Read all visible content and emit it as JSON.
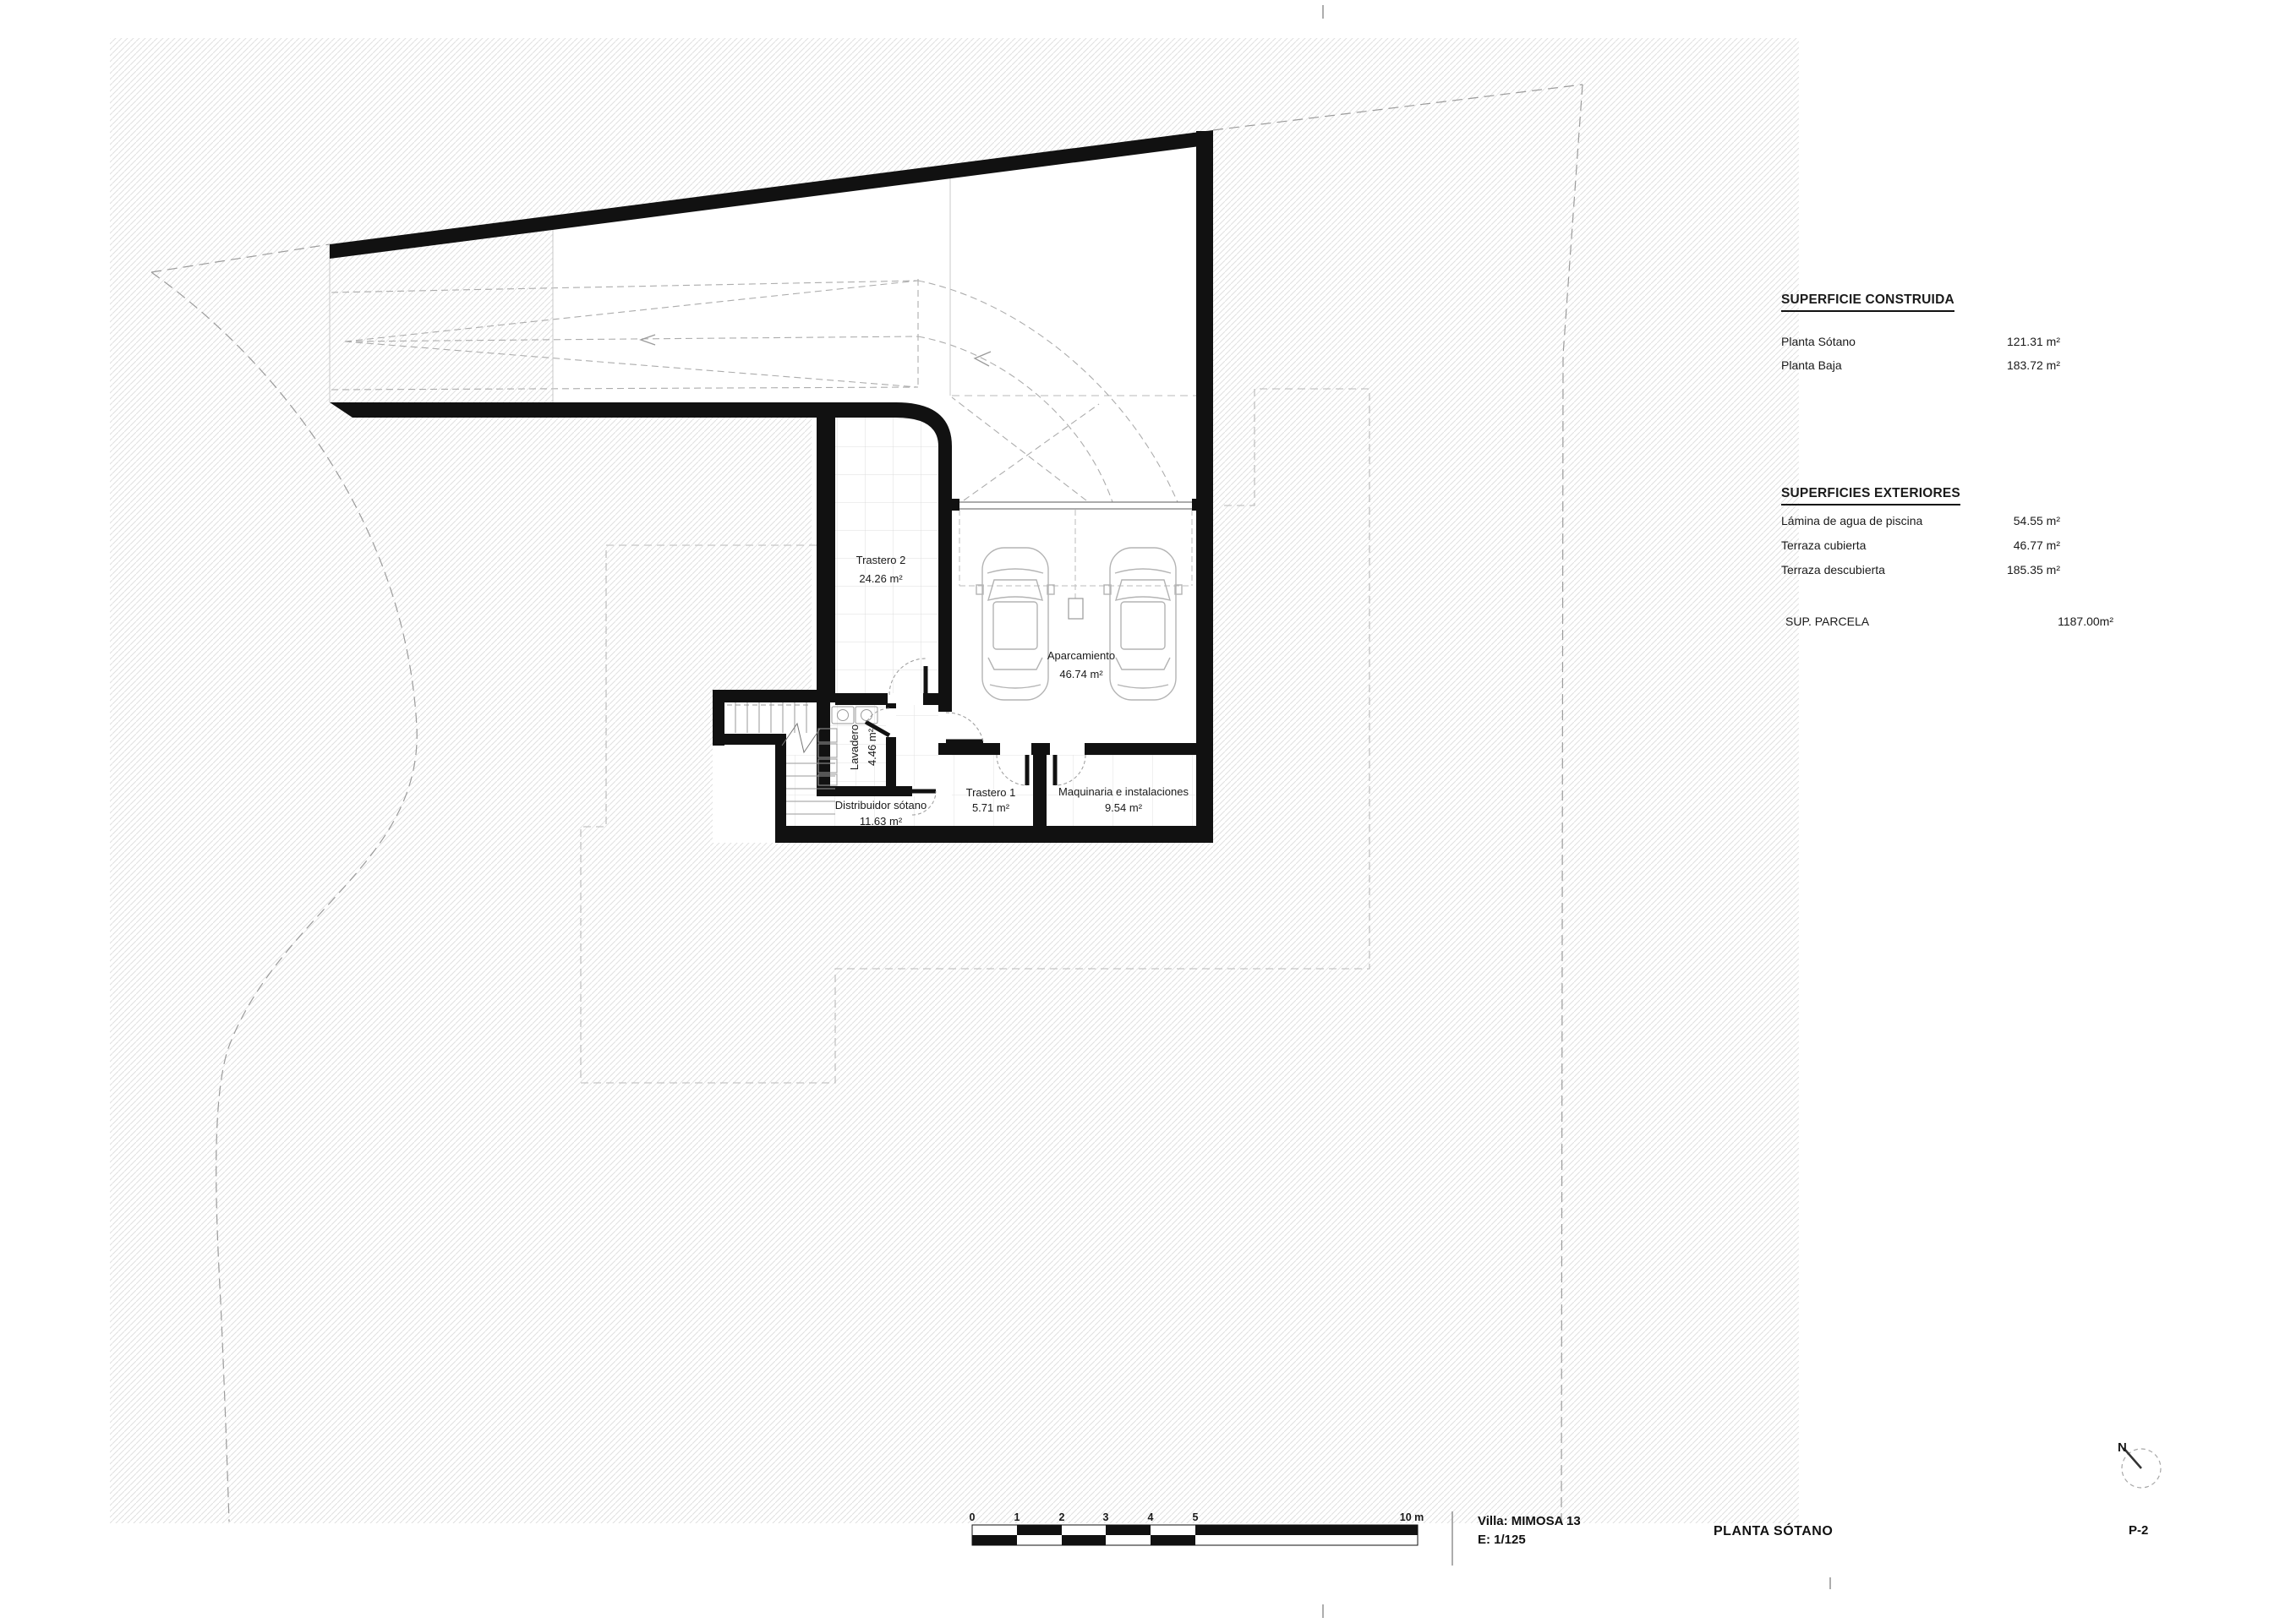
{
  "panel": {
    "construida": {
      "title": "SUPERFICIE CONSTRUIDA",
      "rows": [
        {
          "label": "Planta Sótano",
          "value": "121.31 m²"
        },
        {
          "label": "Planta Baja",
          "value": "183.72 m²"
        }
      ]
    },
    "exteriores": {
      "title": "SUPERFICIES EXTERIORES",
      "rows": [
        {
          "label": "Lámina de agua de piscina",
          "value": "54.55 m²"
        },
        {
          "label": "Terraza cubierta",
          "value": "46.77 m²"
        },
        {
          "label": "Terraza descubierta",
          "value": "185.35 m²"
        }
      ]
    },
    "parcela": {
      "label": "SUP. PARCELA",
      "value": "1187.00m²"
    }
  },
  "rooms": {
    "trastero2": {
      "name": "Trastero 2",
      "area": "24.26 m²"
    },
    "aparcamiento": {
      "name": "Aparcamiento",
      "area": "46.74 m²"
    },
    "trastero1": {
      "name": "Trastero 1",
      "area": "5.71 m²"
    },
    "maquinaria": {
      "name": "Maquinaria e instalaciones",
      "area": "9.54 m²"
    },
    "distribuidor": {
      "name": "Distribuidor sótano",
      "area": "11.63 m²"
    },
    "lavadero": {
      "name": "Lavadero",
      "area": "4.46 m²"
    }
  },
  "titleblock": {
    "villa": "Villa: MIMOSA 13",
    "scale": "E:  1/125",
    "plan": "PLANTA SÓTANO",
    "sheet": "P-2",
    "north": "N"
  },
  "scalebar": {
    "labels": [
      "0",
      "1",
      "2",
      "3",
      "4",
      "5"
    ],
    "end_label": "10 m"
  }
}
